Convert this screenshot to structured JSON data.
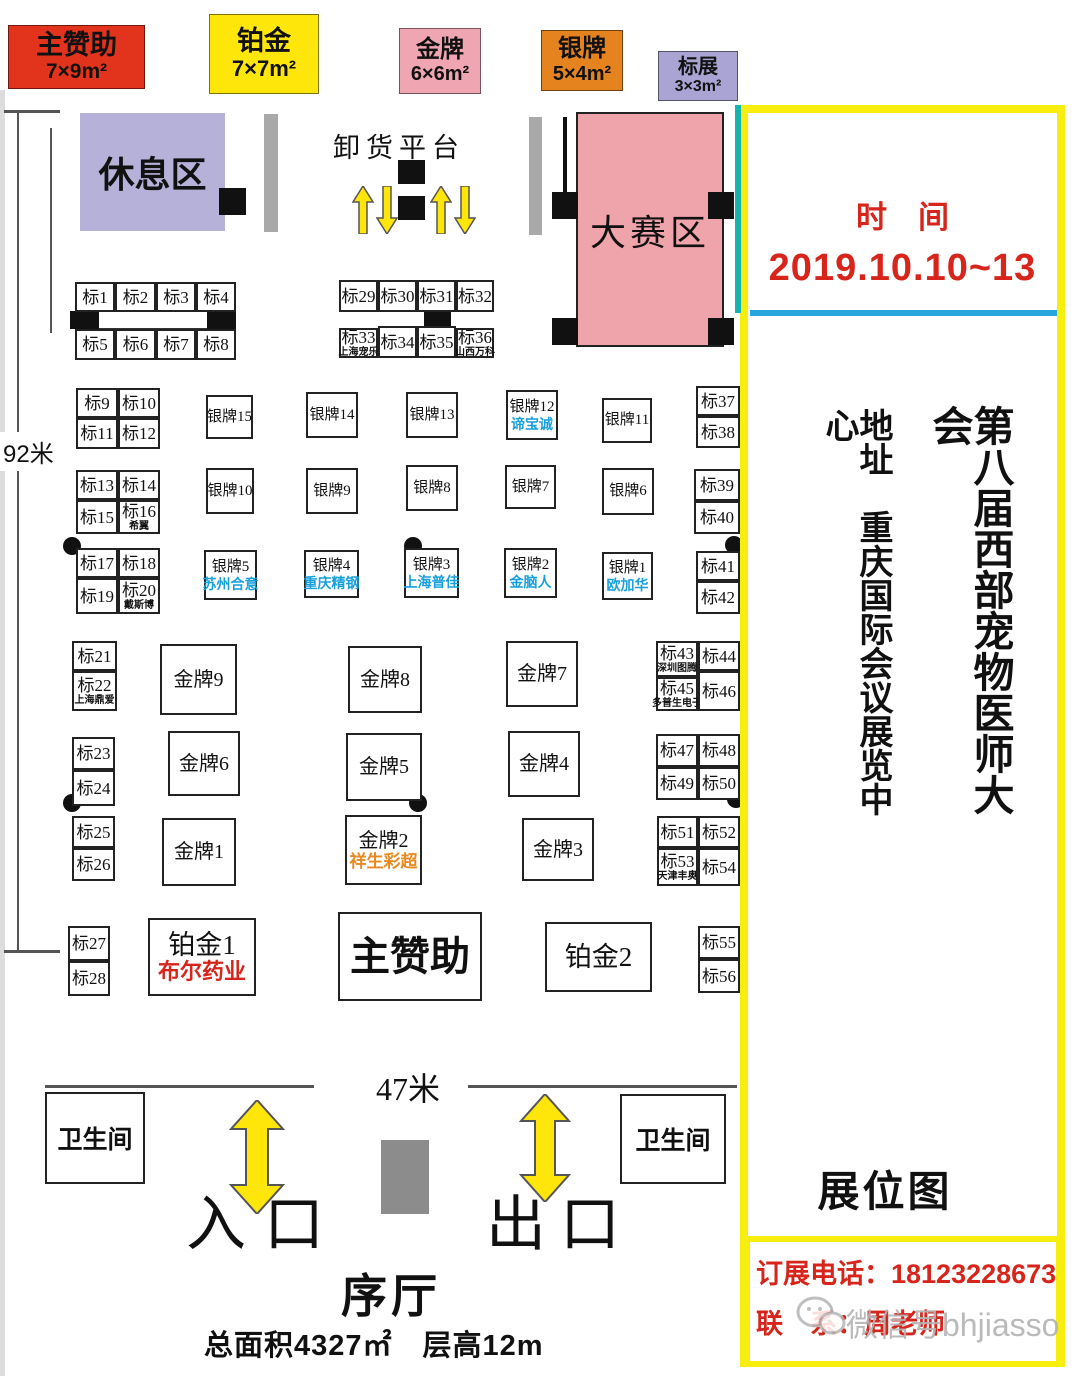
{
  "legend": {
    "items": [
      {
        "label": "主赞助",
        "size": "7×9m²",
        "bg": "#e2331d"
      },
      {
        "label": "铂金",
        "size": "7×7m²",
        "bg": "#ffe60a"
      },
      {
        "label": "金牌",
        "size": "6×6m²",
        "bg": "#f0a6b2"
      },
      {
        "label": "银牌",
        "size": "5×4m²",
        "bg": "#e5831f"
      },
      {
        "label": "标展",
        "size": "3×3m²",
        "bg": "#a9a4d3"
      }
    ]
  },
  "plan": {
    "rest_area": "休息区",
    "unloading_dock": "卸货平台",
    "competition_area": "大赛区",
    "dim_left": "92米",
    "dim_bottom": "47米",
    "toilet": "卫生间",
    "entrance": "入口",
    "exit": "出口",
    "lobby": "序厅",
    "area_info": "总面积4327㎡　层高12m"
  },
  "panel": {
    "time_label": "时　间",
    "dates": "2019.10.10~13",
    "address": "地址　重庆国际会议展览中心",
    "title": "第八届西部宠物医师大会",
    "map_label": "展位图",
    "phone_line": "订展电话：18123228673",
    "contact_line": "联　系：周老师",
    "watermark": "微信号bhjiasso",
    "red": "#d8251c",
    "blue_line": "#28a7de",
    "teal_line": "#12b4ae",
    "border": "#f8ee0e"
  },
  "booths": [
    {
      "type": "std",
      "x": 75,
      "y": 282,
      "w": 40,
      "h": 30,
      "label": "标1"
    },
    {
      "type": "std",
      "x": 115,
      "y": 282,
      "w": 41,
      "h": 30,
      "label": "标2"
    },
    {
      "type": "std",
      "x": 156,
      "y": 282,
      "w": 40,
      "h": 30,
      "label": "标3"
    },
    {
      "type": "std",
      "x": 196,
      "y": 282,
      "w": 40,
      "h": 30,
      "label": "标4"
    },
    {
      "type": "std",
      "x": 75,
      "y": 329,
      "w": 40,
      "h": 31,
      "label": "标5"
    },
    {
      "type": "std",
      "x": 115,
      "y": 329,
      "w": 41,
      "h": 31,
      "label": "标6"
    },
    {
      "type": "std",
      "x": 156,
      "y": 329,
      "w": 40,
      "h": 31,
      "label": "标7"
    },
    {
      "type": "std",
      "x": 196,
      "y": 329,
      "w": 40,
      "h": 31,
      "label": "标8"
    },
    {
      "type": "std",
      "x": 76,
      "y": 388,
      "w": 42,
      "h": 30,
      "label": "标9"
    },
    {
      "type": "std",
      "x": 118,
      "y": 388,
      "w": 42,
      "h": 30,
      "label": "标10"
    },
    {
      "type": "std",
      "x": 76,
      "y": 418,
      "w": 42,
      "h": 31,
      "label": "标11"
    },
    {
      "type": "std",
      "x": 118,
      "y": 418,
      "w": 42,
      "h": 31,
      "label": "标12"
    },
    {
      "type": "std",
      "x": 76,
      "y": 470,
      "w": 42,
      "h": 30,
      "label": "标13"
    },
    {
      "type": "std",
      "x": 118,
      "y": 470,
      "w": 42,
      "h": 30,
      "label": "标14"
    },
    {
      "type": "std",
      "x": 76,
      "y": 500,
      "w": 42,
      "h": 34,
      "label": "标15"
    },
    {
      "type": "std",
      "x": 118,
      "y": 500,
      "w": 42,
      "h": 34,
      "label": "标16",
      "sub": "希翼"
    },
    {
      "type": "std",
      "x": 76,
      "y": 548,
      "w": 42,
      "h": 30,
      "label": "标17"
    },
    {
      "type": "std",
      "x": 118,
      "y": 548,
      "w": 42,
      "h": 30,
      "label": "标18"
    },
    {
      "type": "std",
      "x": 76,
      "y": 578,
      "w": 42,
      "h": 36,
      "label": "标19"
    },
    {
      "type": "std",
      "x": 118,
      "y": 578,
      "w": 42,
      "h": 36,
      "label": "标20",
      "sub": "戴斯博"
    },
    {
      "type": "std",
      "x": 72,
      "y": 641,
      "w": 45,
      "h": 30,
      "label": "标21"
    },
    {
      "type": "std",
      "x": 72,
      "y": 671,
      "w": 45,
      "h": 40,
      "label": "标22",
      "sub": "上海鼎爱"
    },
    {
      "type": "std",
      "x": 72,
      "y": 737,
      "w": 43,
      "h": 33,
      "label": "标23"
    },
    {
      "type": "std",
      "x": 72,
      "y": 770,
      "w": 43,
      "h": 36,
      "label": "标24"
    },
    {
      "type": "std",
      "x": 72,
      "y": 816,
      "w": 43,
      "h": 32,
      "label": "标25"
    },
    {
      "type": "std",
      "x": 72,
      "y": 848,
      "w": 43,
      "h": 33,
      "label": "标26"
    },
    {
      "type": "std",
      "x": 68,
      "y": 926,
      "w": 42,
      "h": 35,
      "label": "标27"
    },
    {
      "type": "std",
      "x": 68,
      "y": 961,
      "w": 42,
      "h": 35,
      "label": "标28"
    },
    {
      "type": "std",
      "x": 339,
      "y": 280,
      "w": 39,
      "h": 32,
      "label": "标29"
    },
    {
      "type": "std",
      "x": 378,
      "y": 280,
      "w": 39,
      "h": 32,
      "label": "标30"
    },
    {
      "type": "std",
      "x": 417,
      "y": 280,
      "w": 39,
      "h": 32,
      "label": "标31"
    },
    {
      "type": "std",
      "x": 456,
      "y": 280,
      "w": 38,
      "h": 32,
      "label": "标32"
    },
    {
      "type": "std",
      "x": 339,
      "y": 328,
      "w": 39,
      "h": 30,
      "label": "标33",
      "sub": "上海宠乐"
    },
    {
      "type": "std",
      "x": 378,
      "y": 326,
      "w": 39,
      "h": 32,
      "label": "标34"
    },
    {
      "type": "std",
      "x": 417,
      "y": 326,
      "w": 39,
      "h": 32,
      "label": "标35"
    },
    {
      "type": "std",
      "x": 456,
      "y": 328,
      "w": 38,
      "h": 30,
      "label": "标36",
      "sub": "山西万科"
    },
    {
      "type": "std",
      "x": 696,
      "y": 386,
      "w": 44,
      "h": 30,
      "label": "标37"
    },
    {
      "type": "std",
      "x": 696,
      "y": 416,
      "w": 44,
      "h": 32,
      "label": "标38"
    },
    {
      "type": "std",
      "x": 694,
      "y": 469,
      "w": 46,
      "h": 32,
      "label": "标39"
    },
    {
      "type": "std",
      "x": 694,
      "y": 501,
      "w": 46,
      "h": 33,
      "label": "标40"
    },
    {
      "type": "std",
      "x": 696,
      "y": 551,
      "w": 44,
      "h": 30,
      "label": "标41"
    },
    {
      "type": "std",
      "x": 696,
      "y": 581,
      "w": 44,
      "h": 33,
      "label": "标42"
    },
    {
      "type": "std",
      "x": 656,
      "y": 641,
      "w": 42,
      "h": 36,
      "label": "标43",
      "sub": "深圳图腾"
    },
    {
      "type": "std",
      "x": 698,
      "y": 641,
      "w": 42,
      "h": 30,
      "label": "标44"
    },
    {
      "type": "std",
      "x": 656,
      "y": 677,
      "w": 42,
      "h": 34,
      "label": "标45",
      "sub": "多普生电子"
    },
    {
      "type": "std",
      "x": 698,
      "y": 671,
      "w": 42,
      "h": 40,
      "label": "标46"
    },
    {
      "type": "std",
      "x": 656,
      "y": 734,
      "w": 42,
      "h": 33,
      "label": "标47"
    },
    {
      "type": "std",
      "x": 698,
      "y": 734,
      "w": 42,
      "h": 33,
      "label": "标48"
    },
    {
      "type": "std",
      "x": 656,
      "y": 767,
      "w": 42,
      "h": 33,
      "label": "标49"
    },
    {
      "type": "std",
      "x": 698,
      "y": 767,
      "w": 42,
      "h": 33,
      "label": "标50"
    },
    {
      "type": "std",
      "x": 657,
      "y": 816,
      "w": 41,
      "h": 32,
      "label": "标51"
    },
    {
      "type": "std",
      "x": 698,
      "y": 816,
      "w": 42,
      "h": 32,
      "label": "标52"
    },
    {
      "type": "std",
      "x": 657,
      "y": 848,
      "w": 41,
      "h": 38,
      "label": "标53",
      "sub": "天津丰奥"
    },
    {
      "type": "std",
      "x": 698,
      "y": 848,
      "w": 42,
      "h": 38,
      "label": "标54"
    },
    {
      "type": "std",
      "x": 698,
      "y": 926,
      "w": 42,
      "h": 33,
      "label": "标55"
    },
    {
      "type": "std",
      "x": 698,
      "y": 959,
      "w": 42,
      "h": 34,
      "label": "标56"
    },
    {
      "type": "silver",
      "x": 206,
      "y": 395,
      "w": 47,
      "h": 44,
      "label": "银牌15"
    },
    {
      "type": "silver",
      "x": 306,
      "y": 392,
      "w": 52,
      "h": 46,
      "label": "银牌14"
    },
    {
      "type": "silver",
      "x": 406,
      "y": 392,
      "w": 52,
      "h": 46,
      "label": "银牌13"
    },
    {
      "type": "silver",
      "x": 506,
      "y": 390,
      "w": 52,
      "h": 50,
      "label": "银牌12",
      "sub": "谛宝诚",
      "sub_color": "#18a0dc"
    },
    {
      "type": "silver",
      "x": 602,
      "y": 398,
      "w": 50,
      "h": 45,
      "label": "银牌11"
    },
    {
      "type": "silver",
      "x": 206,
      "y": 468,
      "w": 48,
      "h": 46,
      "label": "银牌10"
    },
    {
      "type": "silver",
      "x": 306,
      "y": 468,
      "w": 52,
      "h": 46,
      "label": "银牌9"
    },
    {
      "type": "silver",
      "x": 406,
      "y": 465,
      "w": 52,
      "h": 46,
      "label": "银牌8"
    },
    {
      "type": "silver",
      "x": 505,
      "y": 465,
      "w": 51,
      "h": 44,
      "label": "银牌7"
    },
    {
      "type": "silver",
      "x": 602,
      "y": 468,
      "w": 52,
      "h": 47,
      "label": "银牌6"
    },
    {
      "type": "silver",
      "x": 204,
      "y": 550,
      "w": 53,
      "h": 50,
      "label": "银牌5",
      "sub": "苏州合意",
      "sub_color": "#18a0dc"
    },
    {
      "type": "silver",
      "x": 304,
      "y": 550,
      "w": 55,
      "h": 48,
      "label": "银牌4",
      "sub": "重庆精钢",
      "sub_color": "#18a0dc"
    },
    {
      "type": "silver",
      "x": 404,
      "y": 548,
      "w": 55,
      "h": 50,
      "label": "银牌3",
      "sub": "上海普佳",
      "sub_color": "#18a0dc"
    },
    {
      "type": "silver",
      "x": 504,
      "y": 548,
      "w": 53,
      "h": 50,
      "label": "银牌2",
      "sub": "金脑人",
      "sub_color": "#18a0dc"
    },
    {
      "type": "silver",
      "x": 602,
      "y": 552,
      "w": 51,
      "h": 48,
      "label": "银牌1",
      "sub": "欧加华",
      "sub_color": "#18a0dc"
    },
    {
      "type": "gold",
      "x": 160,
      "y": 644,
      "w": 77,
      "h": 71,
      "label": "金牌9"
    },
    {
      "type": "gold",
      "x": 348,
      "y": 646,
      "w": 74,
      "h": 67,
      "label": "金牌8"
    },
    {
      "type": "gold",
      "x": 506,
      "y": 641,
      "w": 72,
      "h": 66,
      "label": "金牌7"
    },
    {
      "type": "gold",
      "x": 168,
      "y": 731,
      "w": 72,
      "h": 65,
      "label": "金牌6"
    },
    {
      "type": "gold",
      "x": 346,
      "y": 733,
      "w": 76,
      "h": 68,
      "label": "金牌5"
    },
    {
      "type": "gold",
      "x": 508,
      "y": 731,
      "w": 72,
      "h": 66,
      "label": "金牌4"
    },
    {
      "type": "gold",
      "x": 162,
      "y": 818,
      "w": 74,
      "h": 68,
      "label": "金牌1"
    },
    {
      "type": "gold",
      "x": 345,
      "y": 815,
      "w": 77,
      "h": 70,
      "label": "金牌2",
      "sub": "祥生彩超",
      "sub_color": "#e8891d"
    },
    {
      "type": "gold",
      "x": 522,
      "y": 818,
      "w": 72,
      "h": 63,
      "label": "金牌3"
    },
    {
      "type": "plat",
      "x": 148,
      "y": 918,
      "w": 108,
      "h": 78,
      "label": "铂金1",
      "sub": "布尔药业",
      "sub_color": "#d8251c"
    },
    {
      "type": "main",
      "x": 338,
      "y": 912,
      "w": 144,
      "h": 89,
      "label": "主赞助"
    },
    {
      "type": "plat",
      "x": 545,
      "y": 922,
      "w": 107,
      "h": 70,
      "label": "铂金2"
    }
  ]
}
